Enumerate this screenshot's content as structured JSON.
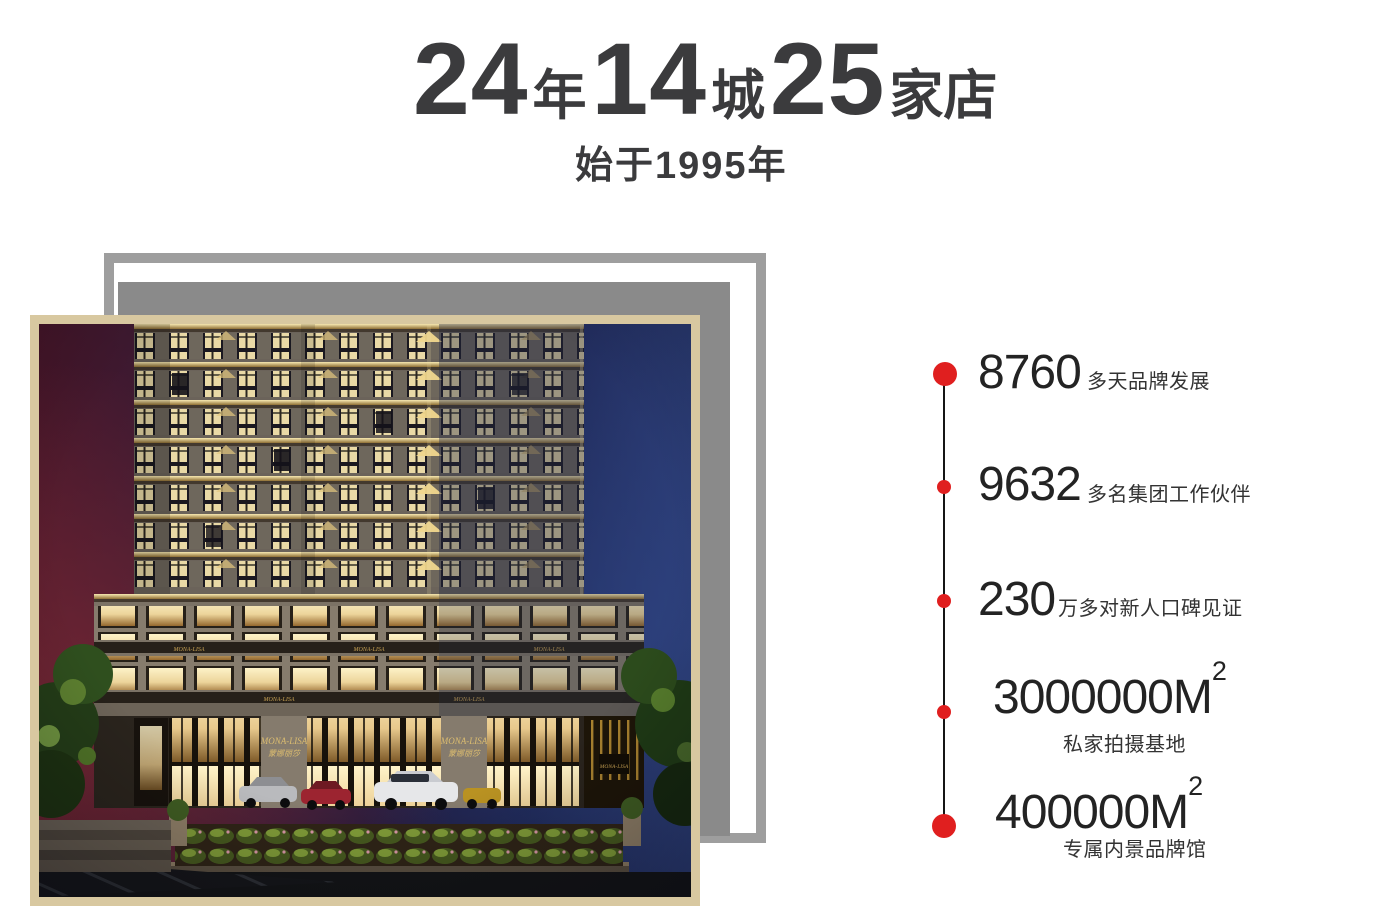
{
  "colors": {
    "accent_red": "#e01f1f",
    "title_gray": "#3b3b3d",
    "frame_outer": "#9e9e9e",
    "frame_mid": "#8a8a8a",
    "photo_border": "#d8c8a0"
  },
  "header": {
    "segments": [
      {
        "num": "24",
        "unit": "年"
      },
      {
        "num": "14",
        "unit": "城"
      },
      {
        "num": "25",
        "unit": "家店"
      }
    ],
    "subtitle": "始于1995年"
  },
  "stats": {
    "items": [
      {
        "value": "8760",
        "label": "多天品牌发展",
        "label_position": "right",
        "dot_size": "large"
      },
      {
        "value": "9632",
        "label": "多名集团工作伙伴",
        "label_position": "right",
        "dot_size": "small"
      },
      {
        "value": "230",
        "label": "万多对新人口碑见证",
        "label_position": "right",
        "dot_size": "small"
      },
      {
        "value": "3000000M",
        "sup": "2",
        "label": "私家拍摄基地",
        "label_position": "below",
        "dot_size": "small"
      },
      {
        "value": "400000M",
        "sup": "2",
        "label": "专属内景品牌馆",
        "label_position": "below",
        "dot_size": "large"
      }
    ]
  },
  "photo": {
    "signage_en": "MONA-LISA",
    "signage_cn": "蒙娜丽莎"
  }
}
